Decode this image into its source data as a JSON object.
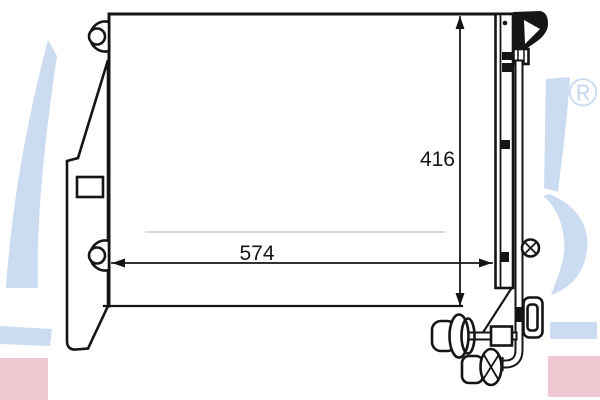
{
  "diagram": {
    "type": "technical-drawing",
    "dimension_labels": {
      "width": "574",
      "height": "416"
    },
    "watermark": {
      "registered_mark": "®"
    },
    "colors": {
      "line": "#151515",
      "watermark_blue": "#cbdcf0",
      "watermark_pink": "#f1c9d3",
      "background": "#ffffff"
    }
  }
}
